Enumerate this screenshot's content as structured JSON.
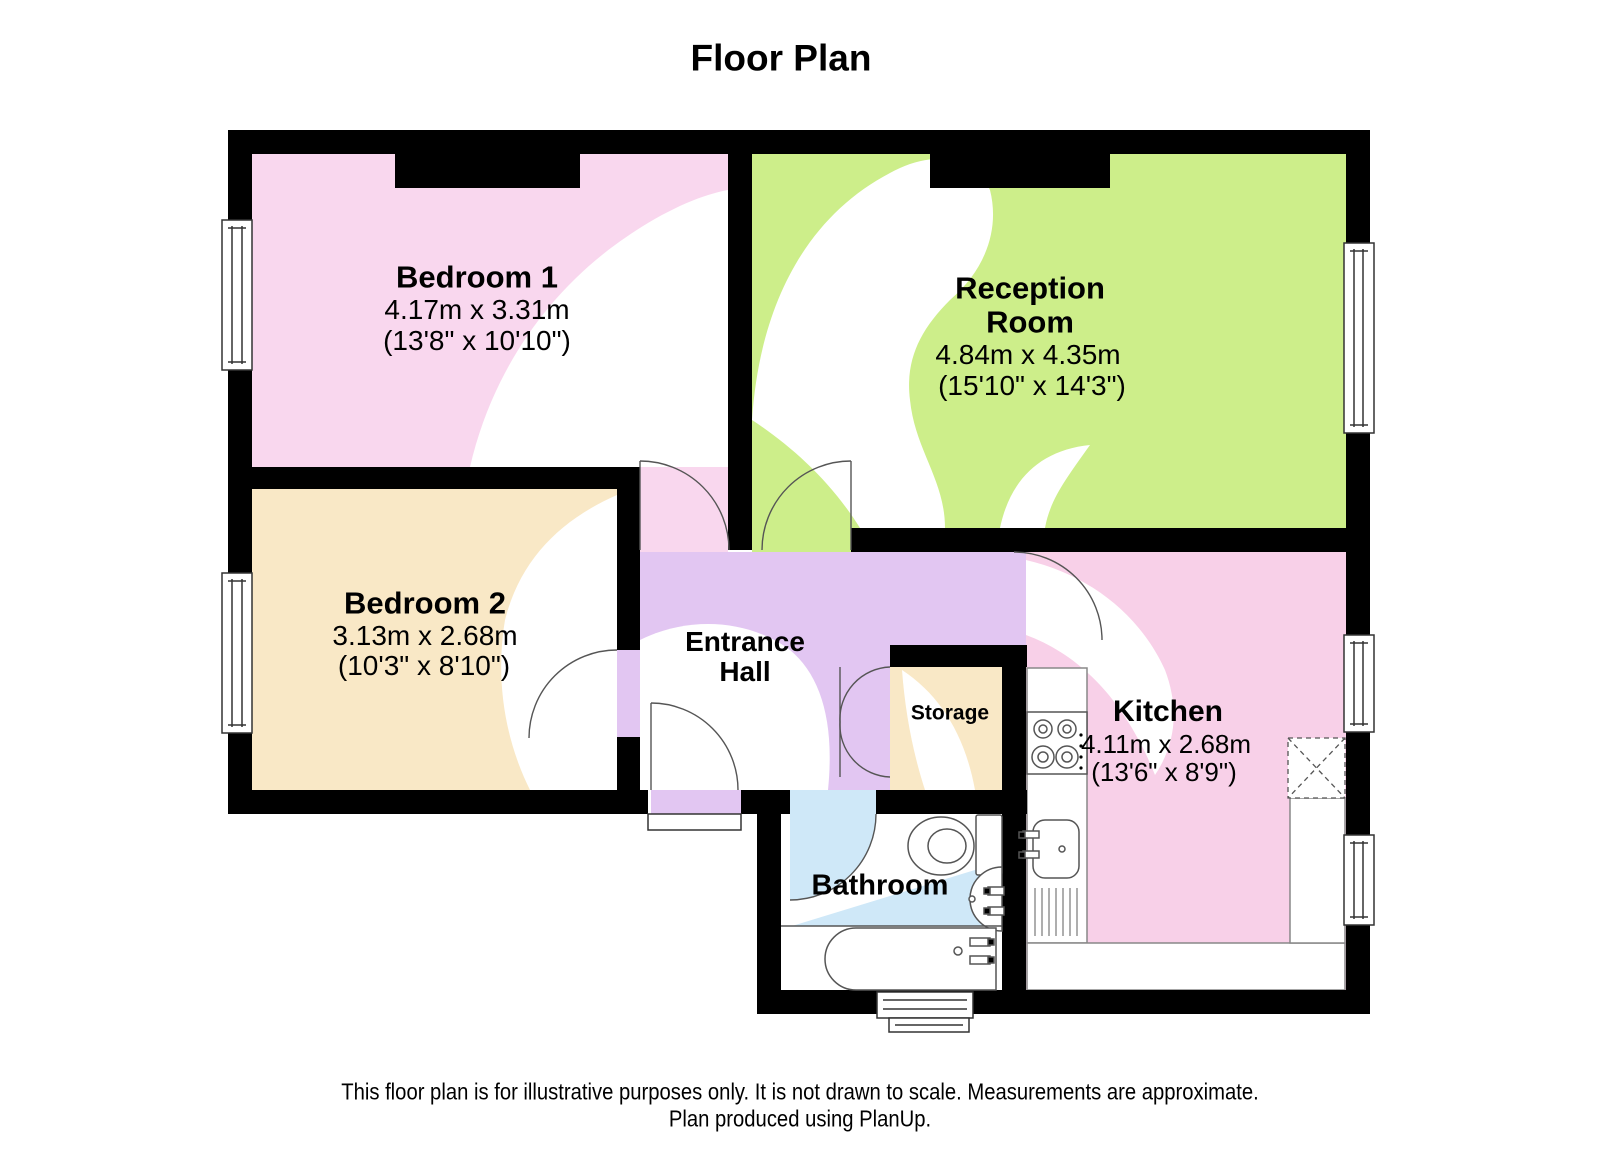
{
  "title": "Floor Plan",
  "rooms": {
    "bedroom1": {
      "name": "Bedroom 1",
      "metric": "4.17m x 3.31m",
      "imperial": "(13'8\" x 10'10\")"
    },
    "reception": {
      "name_line1": "Reception",
      "name_line2": "Room",
      "metric": "4.84m x 4.35m",
      "imperial": "(15'10\" x 14'3\")"
    },
    "bedroom2": {
      "name": "Bedroom 2",
      "metric": "3.13m x 2.68m",
      "imperial": "(10'3\" x 8'10\")"
    },
    "entrance_hall": {
      "name_line1": "Entrance",
      "name_line2": "Hall"
    },
    "storage": {
      "name": "Storage"
    },
    "kitchen": {
      "name": "Kitchen",
      "metric": "4.11m x 2.68m",
      "imperial": "(13'6\" x 8'9\")"
    },
    "bathroom": {
      "name": "Bathroom"
    }
  },
  "footer": {
    "line1": "This floor plan is for illustrative purposes only. It is not drawn to scale. Measurements are approximate.",
    "line2": "Plan produced using PlanUp."
  },
  "colors": {
    "bedroom1_floor": "#f9d7ee",
    "reception_floor": "#cdee8a",
    "bedroom2_floor": "#f9e8c6",
    "entrance_hall_floor": "#e2c6f2",
    "storage_floor": "#f9e8c6",
    "kitchen_floor": "#f8d0e8",
    "bathroom_accent": "#cfe8f8",
    "walls": "#000000"
  }
}
